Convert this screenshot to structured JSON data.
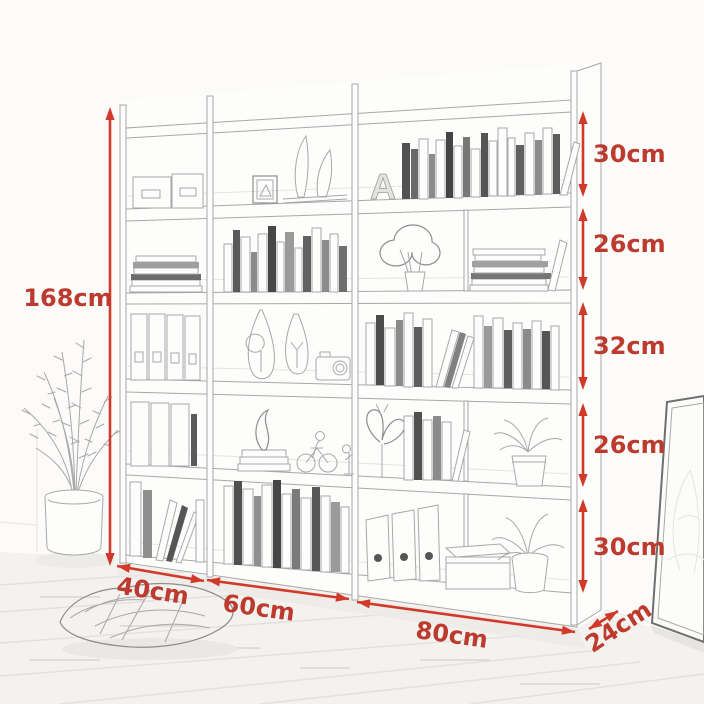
{
  "annotations": {
    "total_height": "168cm",
    "row_heights": [
      "30cm",
      "26cm",
      "32cm",
      "26cm",
      "30cm"
    ],
    "unit_widths": [
      "40cm",
      "60cm",
      "80cm"
    ],
    "depth": "24cm"
  },
  "decor": {
    "letter": "A"
  },
  "palette": {
    "dimension_red": "#d13a2a",
    "label_red": "#bd3a2e",
    "sketch_gray": "#a8a8a8",
    "wall": "#fcfbfa",
    "floor": "#f4f2ef"
  }
}
